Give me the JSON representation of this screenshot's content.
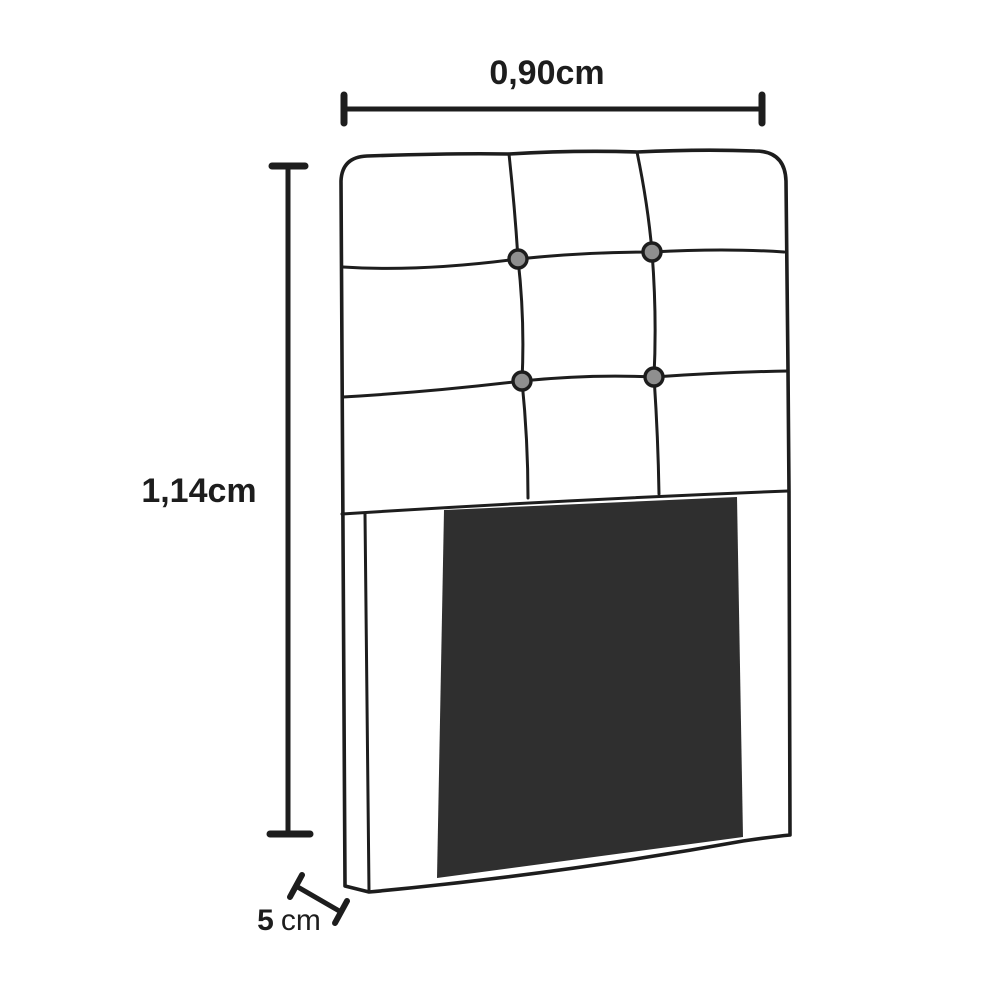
{
  "diagram": {
    "title": "Headboard dimension diagram",
    "subject": "tufted upholstered headboard line drawing",
    "dimensions": {
      "width": {
        "label": "0,90cm"
      },
      "height": {
        "label": "1,14cm"
      },
      "depth": {
        "value": "5",
        "unit": "cm"
      }
    },
    "tufting": {
      "button_count": "4",
      "columns": "3",
      "rows": "3"
    },
    "colors": {
      "background": "#ffffff",
      "line": "#1d1d1d",
      "face_fill": "#ffffff",
      "panel_fill": "#2f2f2f",
      "button_fill": "#8f8f8f"
    }
  }
}
